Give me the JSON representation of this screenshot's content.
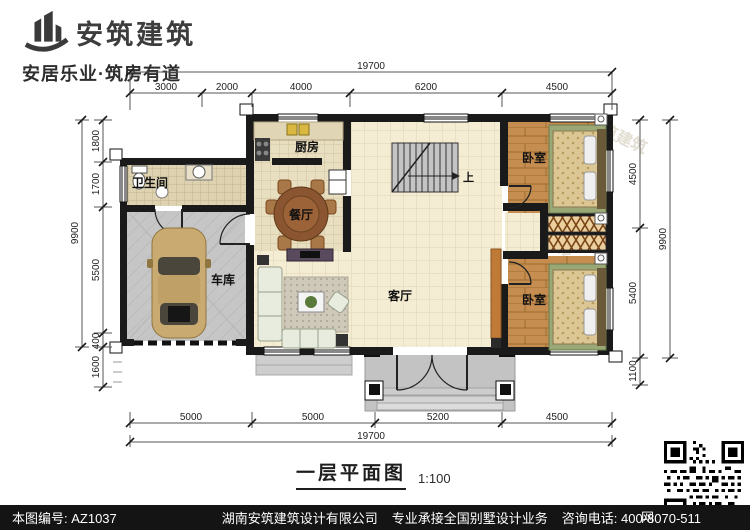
{
  "header": {
    "brand": "安筑建筑",
    "tagline": "安居乐业·筑房有道"
  },
  "rooms": {
    "kitchen": "厨房",
    "dining": "餐厅",
    "bathroom": "卫生间",
    "garage": "车库",
    "living": "客厅",
    "bedroom_top": "卧室",
    "bedroom_bottom": "卧室",
    "stairs_up": "上"
  },
  "dims": {
    "top_total": "19700",
    "top": [
      "3000",
      "2000",
      "4000",
      "6200",
      "4500"
    ],
    "bottom": [
      "5000",
      "5000",
      "5200",
      "4500"
    ],
    "bottom_total": "19700",
    "left": [
      "1800",
      "1700",
      "5500",
      "400",
      "1600"
    ],
    "left_total": "9900",
    "right": [
      "4500",
      "5400",
      "1100"
    ],
    "right_total": "9900"
  },
  "title": {
    "text": "一层平面图",
    "scale": "1:100"
  },
  "footer": {
    "sheet_no": "本图编号: AZ1037",
    "company": "湖南安筑建筑设计有限公司",
    "slogan": "专业承接全国别墅设计业务",
    "phone": "咨询电话: 400-8070-511",
    "web_label": "网"
  },
  "watermark": {
    "brand": "安筑建筑",
    "site": "hnazjz.com"
  },
  "colors": {
    "wall": "#1a1a1a",
    "tile": "#f5edd3",
    "wood": "#c58d4f",
    "concrete": "#c6c6c6",
    "accent_wood": "#c07a38",
    "footer_bg": "#141414"
  }
}
